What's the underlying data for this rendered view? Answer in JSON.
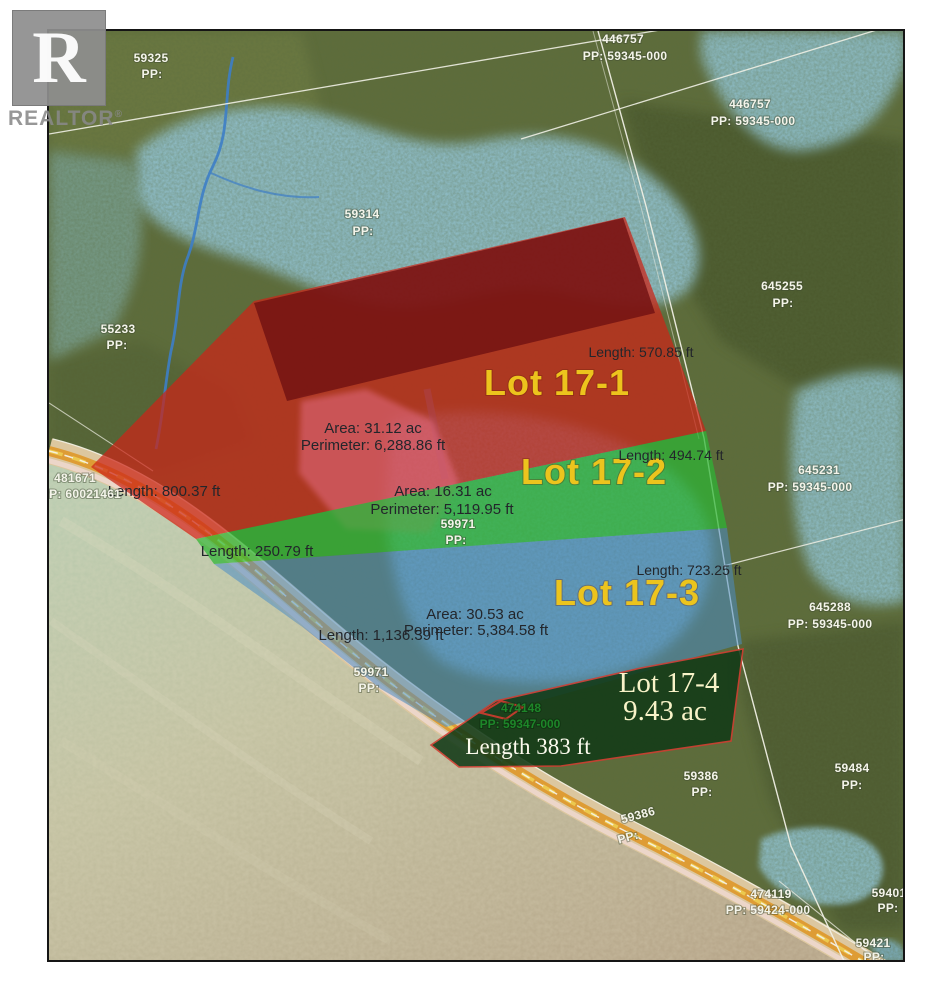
{
  "branding": {
    "logo_letter": "R",
    "logo_text": "REALTOR",
    "registered": "®"
  },
  "colors": {
    "lot1_fill": "#cc2418",
    "lot1_dark_band": "#6f1012",
    "lot2_fill": "#2db534",
    "lot3_fill": "#4a8dc4",
    "lot4_fill": "#123a17",
    "lot4_border": "#d03c30",
    "lot_label_yellow": "#ecc41d",
    "parcel_label_white": "#f4f4ea",
    "road_orange": "#de9c35",
    "forest_green": "#5e6c3b",
    "wetland_blue": "#8fbec9",
    "sea_green": "#b7cdb2",
    "beach_tan": "#dcc79f"
  },
  "lots": [
    {
      "label": "Lot 17-1",
      "area": "Area: 31.12 ac",
      "perimeter": "Perimeter: 6,288.86 ft",
      "length_a": "Length: 570.85 ft",
      "length_b": "Length: 800.37 ft"
    },
    {
      "label": "Lot 17-2",
      "area": "Area: 16.31 ac",
      "perimeter": "Perimeter: 5,119.95 ft",
      "length_a": "Length: 494.74 ft",
      "length_b": "Length: 250.79 ft"
    },
    {
      "label": "Lot 17-3",
      "area": "Area: 30.53 ac",
      "perimeter": "Perimeter: 5,384.58 ft",
      "length_a": "Length: 723.25 ft",
      "length_b": "Length: 1,136.39 ft"
    },
    {
      "label": "Lot 17-4",
      "area": "9.43 ac",
      "length_a": "Length 383 ft"
    }
  ],
  "parcels": [
    {
      "id": "59325",
      "pp": "PP:"
    },
    {
      "id": "446757",
      "pp": "PP: 59345-000"
    },
    {
      "id": "446757",
      "pp": "PP: 59345-000"
    },
    {
      "id": "59314",
      "pp": "PP:"
    },
    {
      "id": "55233",
      "pp": "PP:"
    },
    {
      "id": "645255",
      "pp": "PP:"
    },
    {
      "id": "645231",
      "pp": "PP: 59345-000"
    },
    {
      "id": "645288",
      "pp": "PP: 59345-000"
    },
    {
      "id": "481671",
      "pp": "PP: 60021461"
    },
    {
      "id": "59971",
      "pp": "PP:"
    },
    {
      "id": "59971",
      "pp": "PP:"
    },
    {
      "id": "59386",
      "pp": "PP:"
    },
    {
      "id": "59484",
      "pp": "PP:"
    },
    {
      "id": "59386",
      "pp": "PP:"
    },
    {
      "id": "474119",
      "pp": "PP: 59424-000"
    },
    {
      "id": "59401",
      "pp": "PP:"
    },
    {
      "id": "59421",
      "pp": "PP:"
    },
    {
      "id": "474148",
      "pp": "PP: 59347-000"
    }
  ]
}
